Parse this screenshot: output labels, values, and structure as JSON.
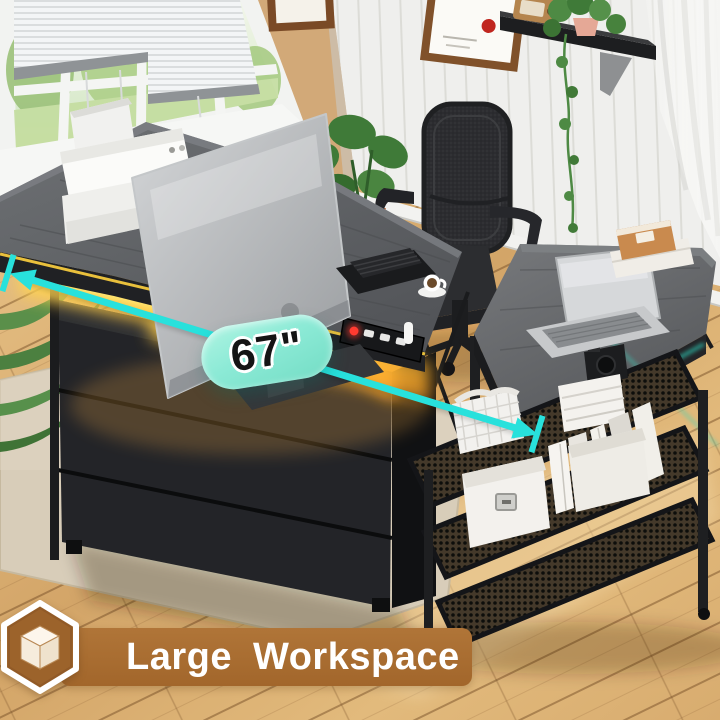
{
  "annotations": {
    "dimension_label": "67\"",
    "arrow_color": "#28e1dc",
    "pill_color": "#8cead6"
  },
  "banner": {
    "label": "Large Workspace",
    "background": "#a2662b",
    "text_color": "#ffffff",
    "badge": {
      "shape": "hexagon",
      "border_color": "#ffffff",
      "fill": "#9c632b",
      "icon": "cube-3d-icon",
      "icon_color": "#f8efe2"
    }
  },
  "scene_colors": {
    "led_yellow": "#ffd84e",
    "led_orange": "#ff9e1b",
    "led_teal": "#2fd8c0",
    "desk_top_gray": "#5f6164",
    "frame_black": "#202124",
    "wall_tan": "#d9b488",
    "wall_panel_white": "#ededeb",
    "floor_wood": "#d8ac6f",
    "rug_beige": "#d8cdb9"
  }
}
